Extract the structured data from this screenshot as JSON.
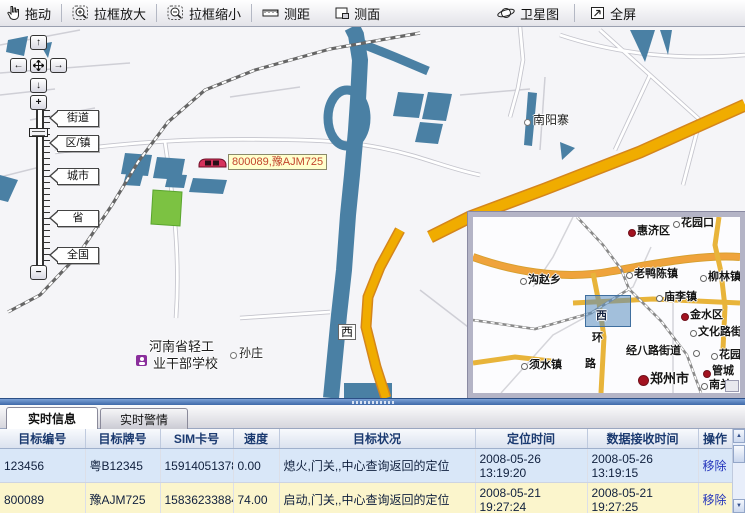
{
  "toolbar": {
    "items": [
      {
        "name": "drag",
        "label": "拖动"
      },
      {
        "name": "box-zoom-in",
        "label": "拉框放大"
      },
      {
        "name": "box-zoom-out",
        "label": "拉框缩小"
      },
      {
        "name": "measure-distance",
        "label": "测距"
      },
      {
        "name": "measure-area",
        "label": "测面"
      },
      {
        "name": "satellite",
        "label": "卫星图"
      },
      {
        "name": "fullscreen",
        "label": "全屏"
      }
    ]
  },
  "map": {
    "pan": {
      "up": "↑",
      "left": "←",
      "right": "→",
      "down": "↓"
    },
    "zoom_in": "+",
    "zoom_out": "−",
    "zoom_levels": [
      "街道",
      "区/镇",
      "城市",
      "省",
      "全国"
    ],
    "labels": [
      {
        "text": "南阳寨"
      },
      {
        "text": "孙庄"
      },
      {
        "text": "河南省轻工"
      },
      {
        "text": "业干部学校"
      },
      {
        "text": "西"
      }
    ],
    "vehicle": {
      "label": "800089,豫AJM725"
    }
  },
  "inset": {
    "labels": [
      {
        "text": "惠济区",
        "marker": "red-dot"
      },
      {
        "text": "花园口",
        "marker": "circle"
      },
      {
        "text": "老鸭陈镇",
        "marker": "circle"
      },
      {
        "text": "柳林镇",
        "marker": "circle"
      },
      {
        "text": "沟赵乡",
        "marker": "circle"
      },
      {
        "text": "庙李镇",
        "marker": "circle"
      },
      {
        "text": "金水区",
        "marker": "red-dot"
      },
      {
        "text": "文化路街",
        "marker": "circle"
      },
      {
        "text": "经八路街道",
        "marker": "circle"
      },
      {
        "text": "花园",
        "marker": "circle"
      },
      {
        "text": "须水镇",
        "marker": "circle"
      },
      {
        "text": "郑州市",
        "marker": "red-dot-large"
      },
      {
        "text": "管城",
        "marker": "red-dot"
      },
      {
        "text": "南关",
        "marker": "circle"
      },
      {
        "text": "环",
        "marker": "none"
      },
      {
        "text": "路",
        "marker": "none"
      },
      {
        "text": "西",
        "marker": "none"
      }
    ]
  },
  "tabs": [
    {
      "label": "实时信息",
      "active": true
    },
    {
      "label": "实时警情",
      "active": false
    }
  ],
  "table": {
    "headers": [
      "目标编号",
      "目标牌号",
      "SIM卡号",
      "速度",
      "目标状况",
      "定位时间",
      "数据接收时间",
      "操作"
    ],
    "rows": [
      [
        "123456",
        "粤B12345",
        "15914051378",
        "0.00",
        "熄火,门关,,中心查询返回的定位",
        "2008-05-26 13:19:20",
        "2008-05-26 13:19:15",
        "移除"
      ],
      [
        "800089",
        "豫AJM725",
        "15836233884",
        "74.00",
        "启动,门关,,中心查询返回的定位",
        "2008-05-21 19:27:24",
        "2008-05-21 19:27:25",
        "移除"
      ]
    ]
  },
  "colors": {
    "water": "#4A80A4",
    "road_major": "#F0AC00",
    "park": "#7CC242",
    "row_blue": "#D9E7F8",
    "row_yellow": "#FBF5CC",
    "link": "#2233BB",
    "marker_label_bg": "#FFFFCC",
    "marker_label_text": "#C2452D"
  }
}
